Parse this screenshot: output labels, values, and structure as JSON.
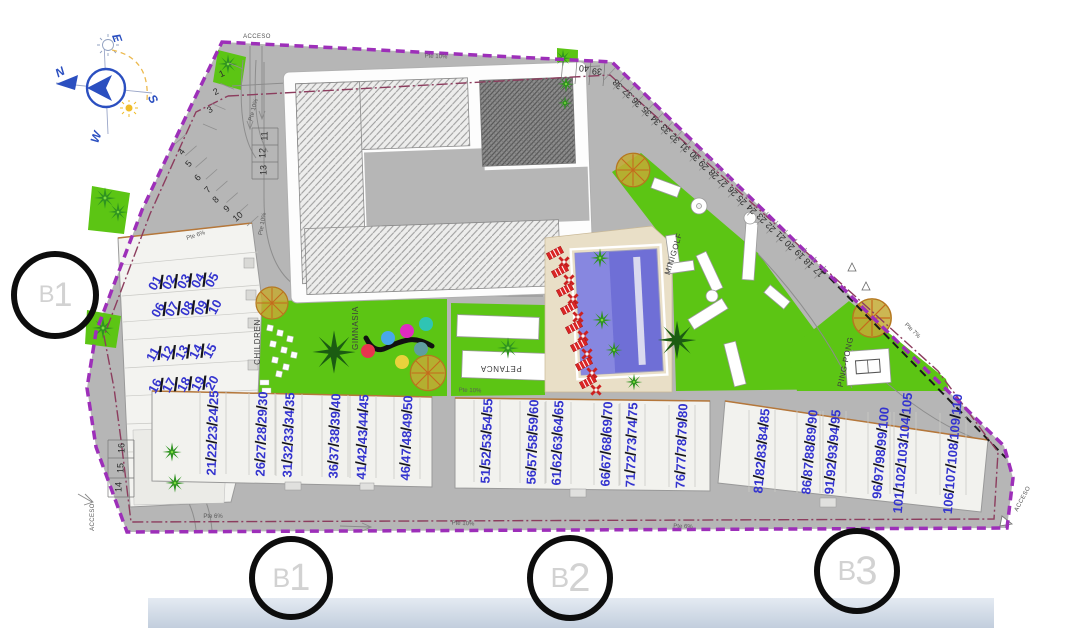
{
  "compass": {
    "north": "N",
    "east": "E",
    "south": "S",
    "west": "W"
  },
  "access": {
    "top": "ACCESO",
    "bottom_left": "ACCESO",
    "bottom_right": "ACCESO"
  },
  "areas": {
    "children": "CHILDREN",
    "gym": "GIMNASIA",
    "petanca": "PETANCA",
    "minigolf": "MINIGOLF",
    "pingpong": "PING-PONG"
  },
  "markers": {
    "left": "B1",
    "bottom": [
      "B1",
      "B2",
      "B3"
    ]
  },
  "slopes": [
    "Pte 10%",
    "Pte 6%",
    "Pte 6%",
    "Pte 10%",
    "Pte 10%",
    "Pte 7%",
    "Pte 6%",
    "Pte 10%",
    "Pte 10%"
  ],
  "parking": {
    "left_row": [
      "1",
      "2",
      "3",
      "4",
      "5",
      "6",
      "7",
      "8",
      "9",
      "10"
    ],
    "stack_upper": [
      "11",
      "12",
      "13"
    ],
    "stack_lower": [
      "14",
      "15",
      "16"
    ],
    "top_pair": [
      "39",
      "40"
    ],
    "diagonal": [
      "38",
      "37",
      "36",
      "35",
      "34",
      "33",
      "32",
      "31",
      "30",
      "29",
      "28",
      "27",
      "26",
      "25",
      "24",
      "23",
      "22",
      "21",
      "20",
      "19",
      "18",
      "17"
    ]
  },
  "units": {
    "left_block": [
      [
        "01",
        "02",
        "03",
        "04",
        "05"
      ],
      [
        "06",
        "07",
        "08",
        "09",
        "10"
      ],
      [
        "11",
        "12",
        "13",
        "14",
        "15"
      ],
      [
        "16",
        "17",
        "18",
        "19",
        "20"
      ]
    ],
    "bottom_groups": [
      [
        "21",
        "22",
        "23",
        "24",
        "25"
      ],
      [
        "26",
        "27",
        "28",
        "29",
        "30"
      ],
      [
        "31",
        "32",
        "33",
        "34",
        "35"
      ],
      [
        "36",
        "37",
        "38",
        "39",
        "40"
      ],
      [
        "41",
        "42",
        "43",
        "44",
        "45"
      ],
      [
        "46",
        "47",
        "48",
        "49",
        "50"
      ],
      [
        "51",
        "52",
        "53",
        "54",
        "55"
      ],
      [
        "56",
        "57",
        "58",
        "59",
        "60"
      ],
      [
        "61",
        "62",
        "63",
        "64",
        "65"
      ],
      [
        "66",
        "67",
        "68",
        "69",
        "70"
      ],
      [
        "71",
        "72",
        "73",
        "74",
        "75"
      ],
      [
        "76",
        "77",
        "78",
        "79",
        "80"
      ],
      [
        "81",
        "82",
        "83",
        "84",
        "85"
      ],
      [
        "86",
        "87",
        "88",
        "89",
        "90"
      ],
      [
        "91",
        "92",
        "93",
        "94",
        "95"
      ],
      [
        "96",
        "97",
        "98",
        "99",
        "100"
      ],
      [
        "101",
        "102",
        "103",
        "104",
        "105"
      ],
      [
        "106",
        "107",
        "108",
        "109",
        "110"
      ]
    ]
  },
  "colors": {
    "boundary": "#9d2fb9",
    "green": "#5cc514",
    "road": "#b6b6b6",
    "pool": "#6f6fd6",
    "unit_number": "#3434cf",
    "lounger": "#da2525",
    "band": "#ccd6e2"
  }
}
